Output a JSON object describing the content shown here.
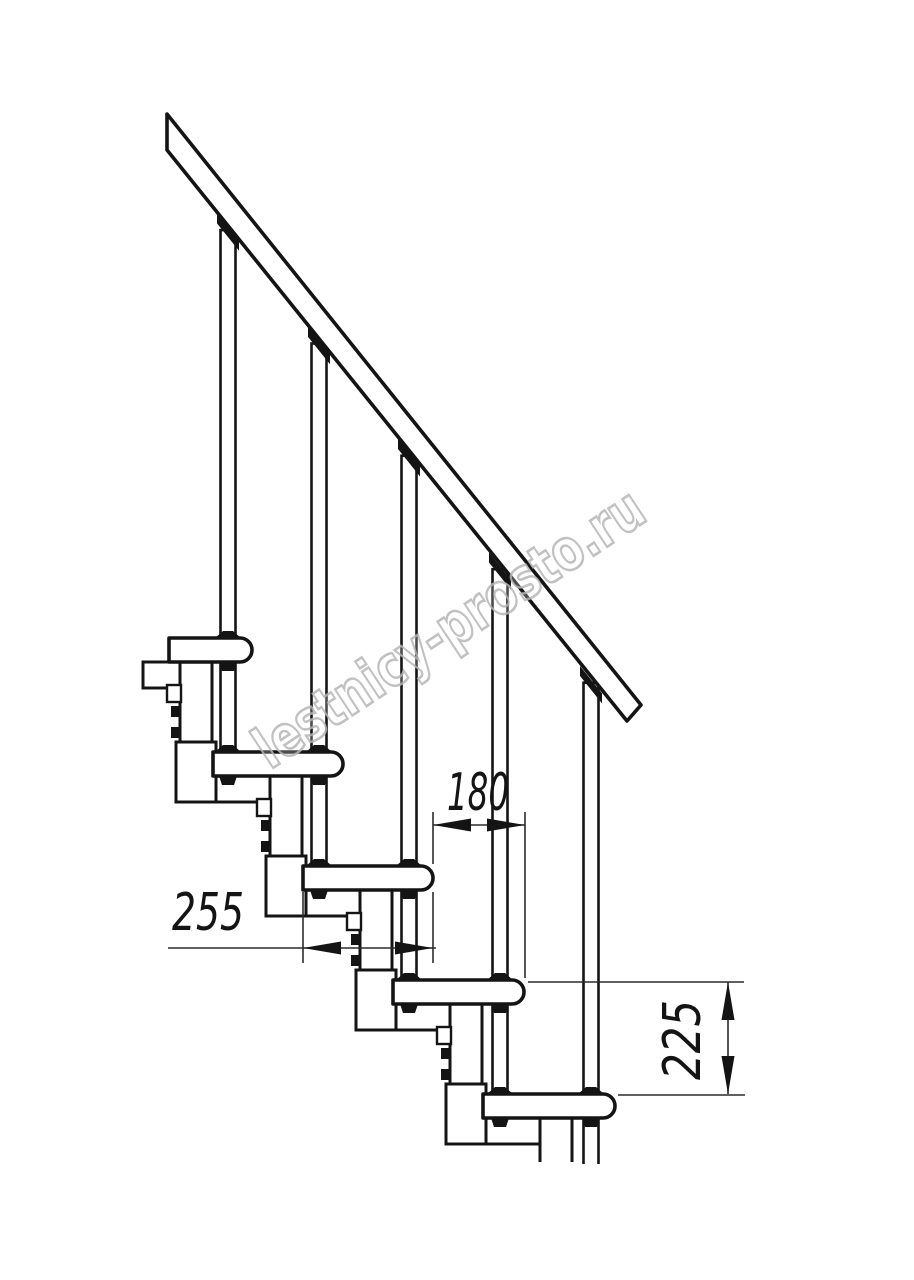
{
  "page": {
    "background": "#ffffff",
    "width": 914,
    "height": 1280
  },
  "watermark": {
    "text": "lestnicy-prosto.ru",
    "color": "#b7b7b7"
  },
  "dimensions": {
    "step_run_label": "180",
    "tread_depth_label": "255",
    "step_rise_label": "225"
  },
  "drawing": {
    "line_color": "#141414",
    "thin_color": "#2b2b2b",
    "tread_h": 24,
    "tread_r": 12,
    "treads": [
      {
        "xL": 169,
        "xR": 252,
        "top": 638
      },
      {
        "xL": 213,
        "xR": 343,
        "top": 752
      },
      {
        "xL": 303,
        "xR": 433,
        "top": 866
      },
      {
        "xL": 393,
        "xR": 524,
        "top": 980
      },
      {
        "xL": 483,
        "xR": 615,
        "top": 1094
      }
    ],
    "bodies": [
      [
        143,
        662,
        180,
        688
      ],
      [
        187,
        776,
        270,
        802
      ],
      [
        277,
        890,
        360,
        916
      ],
      [
        367,
        1004,
        450,
        1030
      ],
      [
        457,
        1118,
        540,
        1144
      ]
    ],
    "stems": [
      [
        180,
        662,
        212,
        742
      ],
      [
        270,
        776,
        302,
        856
      ],
      [
        360,
        890,
        392,
        970
      ],
      [
        450,
        1004,
        482,
        1084
      ]
    ],
    "sockets": [
      [
        176,
        742,
        216,
        802
      ],
      [
        266,
        856,
        306,
        916
      ],
      [
        356,
        970,
        396,
        1030
      ],
      [
        446,
        1084,
        486,
        1144
      ]
    ],
    "stem5": [
      540,
      1118,
      572,
      1162
    ],
    "bolts": [
      [
        171,
        706
      ],
      [
        171,
        727
      ],
      [
        261,
        820
      ],
      [
        261,
        841
      ],
      [
        351,
        934
      ],
      [
        351,
        955
      ],
      [
        441,
        1048
      ],
      [
        441,
        1069
      ]
    ],
    "bolt_w": 10,
    "bolt_h": 11,
    "tabs": [
      [
        167,
        685
      ],
      [
        257,
        799
      ],
      [
        347,
        913
      ],
      [
        437,
        1027
      ]
    ],
    "tab_w": 14,
    "tab_h": 17,
    "balusters": {
      "xcs": [
        228,
        319,
        409,
        500,
        591
      ],
      "bottoms": [
        752,
        866,
        980,
        1094,
        1164
      ],
      "w": 15
    },
    "rail": [
      [
        167,
        114
      ],
      [
        641,
        705
      ],
      [
        627,
        721
      ],
      [
        167,
        150
      ]
    ],
    "rail_lower_edge": {
      "m": 1.2468,
      "b": -58.2
    },
    "collars": [
      [
        228
      ],
      [
        228,
        319
      ],
      [
        319,
        409
      ],
      [
        409,
        500
      ],
      [
        500,
        591
      ]
    ],
    "dims": {
      "d180": {
        "line_y": 825,
        "x1": 433,
        "x2": 525,
        "ext525": [
          812,
          978
        ],
        "text_x": 478,
        "text_y": 810,
        "text_len": 62
      },
      "d255": {
        "line_y": 948,
        "x1": 303,
        "x2": 433,
        "line_from": 168,
        "ext303": [
          892,
          963
        ],
        "ext433a": [
          812,
          864
        ],
        "ext433b": [
          892,
          963
        ],
        "text_x": 208,
        "text_y": 930,
        "text_len": 72
      },
      "d225": {
        "line_x": 728,
        "y1": 982,
        "y2": 1094,
        "extTop": [
          528,
          744,
          982
        ],
        "extBot": [
          618,
          745,
          1095
        ],
        "text_cx": 700,
        "text_cy": 1040,
        "text_len": 80
      },
      "font_size": 52,
      "arrow_len": 38,
      "arrow_hw": 6.5
    },
    "wm": {
      "x": 270,
      "y": 770,
      "angle": -33.5,
      "font_size": 57,
      "text_len": 455
    }
  }
}
